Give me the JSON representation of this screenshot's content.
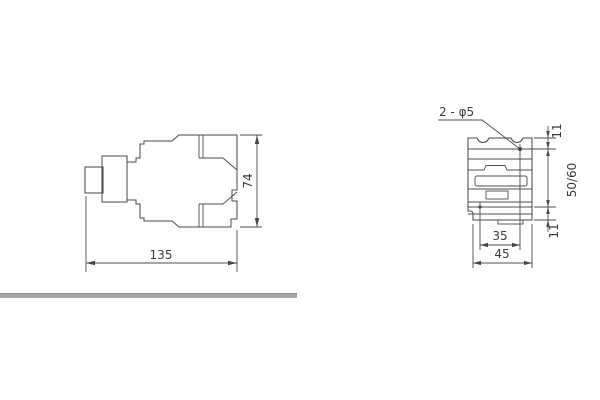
{
  "colors": {
    "background": "#ffffff",
    "line": "#474747",
    "text": "#3a3a3a",
    "divider_bar": "#a9a7a8"
  },
  "side_view": {
    "width_mm": "135",
    "height_mm": "74"
  },
  "front_view": {
    "hole_callout": "2 - φ5",
    "top_offset_mm": "11",
    "vertical_hole_spacing_mm": "50/60",
    "bottom_offset_mm": "11",
    "horizontal_hole_spacing_mm": "35",
    "base_width_mm": "45"
  }
}
